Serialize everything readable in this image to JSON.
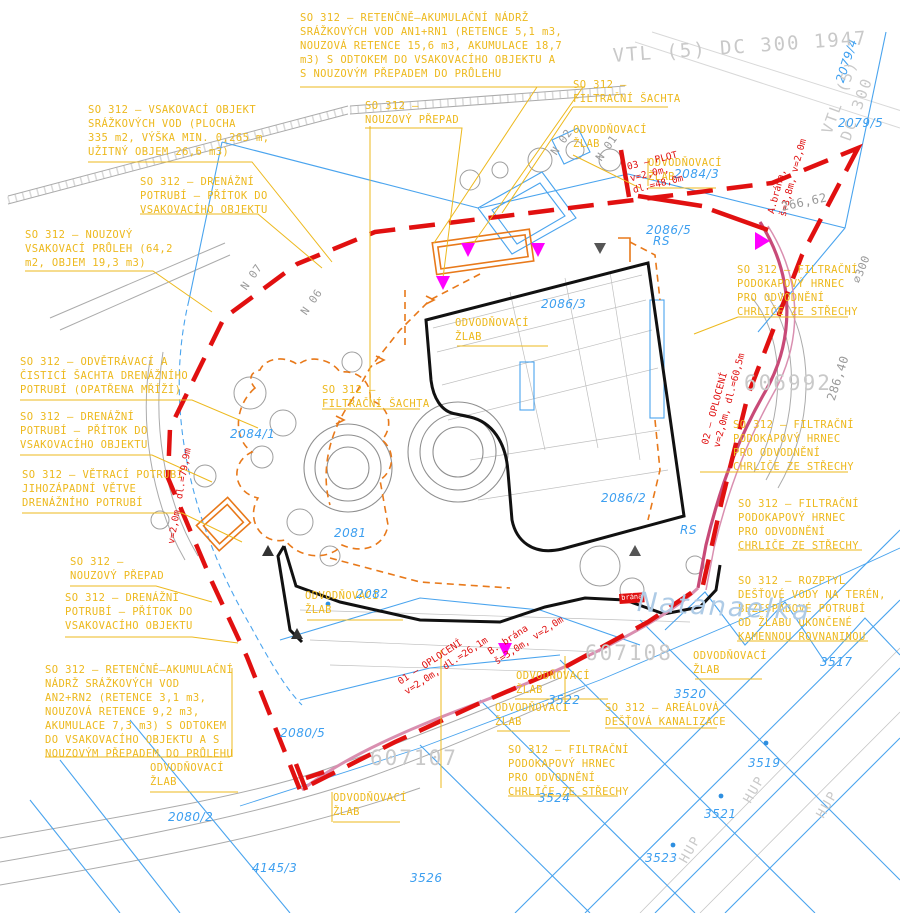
{
  "document_type": "site drainage plan (CAD drawing)",
  "palette": {
    "label_yellow": "#EDB91E",
    "drainage_orange": "#E8791A",
    "boundary_red": "#E01010",
    "road_crimson": "#C84A78",
    "marker_magenta": "#FF00FF",
    "parcel_blue": "#3D9FF0",
    "cadastre_blue": "#4AA4EE",
    "base_gray": "#9A9A9A",
    "pale_gray": "#C9C9C9",
    "building_black": "#111111"
  },
  "annotations": {
    "so312_labels": [
      {
        "id": "an1",
        "x": 300,
        "y": 12,
        "t": "SO 312 – RETENČNĚ–AKUMULAČNÍ NÁDRŽ\nSRÁŽKOVÝCH VOD AN1+RN1 (RETENCE 5,1 m3,\nNOUZOVÁ RETENCE 15,6 m3, AKUMULACE 18,7\nm3) S ODTOKEM DO VSAKOVACÍHO OBJEKTU A\nS NOUZOVÝM PŘEPADEM DO PRŮLEHU"
      },
      {
        "id": "vsak-objekt",
        "x": 88,
        "y": 104,
        "t": "SO 312 – VSAKOVACÍ OBJEKT\nSRÁŽKOVÝCH VOD (PLOCHA\n335 m2, VÝŠKA MIN. 0,265 m,\nUŽITNÝ OBJEM 26,6 m3)"
      },
      {
        "id": "drenazni-1",
        "x": 140,
        "y": 176,
        "t": "SO 312 – DRENÁŽNÍ\nPOTRUBÍ – PŘÍTOK DO\nVSAKOVACÍHO OBJEKTU"
      },
      {
        "id": "nouzovy-pruleh",
        "x": 25,
        "y": 229,
        "t": "SO 312 – NOUZOVÝ\nVSAKOVACÍ PRŮLEH (64,2\nm2, OBJEM 19,3 m3)"
      },
      {
        "id": "nouzovy-prepad-top",
        "x": 365,
        "y": 100,
        "t": "SO 312 –\nNOUZOVÝ PŘEPAD"
      },
      {
        "id": "filtracni-sachta-top",
        "x": 573,
        "y": 79,
        "t": "SO 312 –\nFILTRAČNÍ ŠACHTA"
      },
      {
        "id": "odvetravaci-sachta",
        "x": 20,
        "y": 356,
        "t": "SO 312 – ODVĚTRÁVACÍ A\nČISTICÍ ŠACHTA DRENÁŽNÍHO\nPOTRUBÍ (OPATŘENA MŘÍŽÍ)"
      },
      {
        "id": "drenazni-2",
        "x": 20,
        "y": 411,
        "t": "SO 312 – DRENÁŽNÍ\nPOTRUBÍ – PŘÍTOK DO\nVSAKOVACÍHO OBJEKTU"
      },
      {
        "id": "vetraci-potrubi",
        "x": 22,
        "y": 469,
        "t": "SO 312 – VĚTRACÍ POTRUBÍ\nJIHOZÁPADNÍ VĚTVE\nDRENÁŽNÍHO POTRUBÍ"
      },
      {
        "id": "nouzovy-prepad-left",
        "x": 70,
        "y": 556,
        "t": "SO 312 –\nNOUZOVÝ PŘEPAD"
      },
      {
        "id": "drenazni-3",
        "x": 65,
        "y": 592,
        "t": "SO 312 – DRENÁŽNÍ\nPOTRUBÍ – PŘÍTOK DO\nVSAKOVACÍHO OBJEKTU"
      },
      {
        "id": "an2",
        "x": 45,
        "y": 664,
        "t": "SO 312 – RETENČNĚ–AKUMULAČNÍ\nNÁDRŽ SRÁŽKOVÝCH VOD\nAN2+RN2 (RETENCE 3,1 m3,\nNOUZOVÁ RETENCE 9,2 m3,\nAKUMULACE 7,3 m3) S ODTOKEM\nDO VSAKOVACÍHO OBJEKTU A S\nNOUZOVÝM PŘEPADEM DO PRŮLEHU"
      },
      {
        "id": "filtracni-sachta-mid",
        "x": 322,
        "y": 384,
        "t": "SO 312 –\nFILTRAČNÍ ŠACHTA"
      },
      {
        "id": "hrnec-1",
        "x": 737,
        "y": 264,
        "t": "SO 312 – FILTRAČNÍ\nPODOKAPOVÝ HRNEC\nPRO ODVODNĚNÍ\nCHRLIČE ZE STŘECHY"
      },
      {
        "id": "hrnec-2",
        "x": 733,
        "y": 419,
        "t": "SO 312 – FILTRAČNÍ\nPODOKAPOVÝ HRNEC\nPRO ODVODNĚNÍ\nCHRLIČE ZE STŘECHY"
      },
      {
        "id": "hrnec-3",
        "x": 738,
        "y": 498,
        "t": "SO 312 – FILTRAČNÍ\nPODOKAPOVÝ HRNEC\nPRO ODVODNĚNÍ\nCHRLIČE ZE STŘECHY"
      },
      {
        "id": "rozptyl",
        "x": 738,
        "y": 575,
        "t": "SO 312 – ROZPTYL\nDEŠŤOVÉ VODY NA TERÉN,\nBEZESPÁDOVÉ POTRUBÍ\nOD ŽLABU UKONČENÉ\nKAMENNOU ROVNANINOU"
      },
      {
        "id": "arealova-kanalizace",
        "x": 605,
        "y": 702,
        "t": "SO 312 – AREÁLOVÁ\nDEŠŤOVÁ KANALIZACE"
      },
      {
        "id": "hrnec-4",
        "x": 508,
        "y": 744,
        "t": "SO 312 – FILTRAČNÍ\nPODOKAPOVÝ HRNEC\nPRO ODVODNĚNÍ\nCHRLIČE ZE STŘECHY"
      }
    ],
    "gutter_labels": [
      {
        "id": "zlab-tr1",
        "x": 573,
        "y": 124,
        "t": "ODVODŇOVACÍ\nŽLAB"
      },
      {
        "id": "zlab-tr2",
        "x": 648,
        "y": 157,
        "t": "ODVODŇOVACÍ\nŽLAB"
      },
      {
        "id": "zlab-center",
        "x": 455,
        "y": 317,
        "t": "ODVODŇOVACÍ\nŽLAB"
      },
      {
        "id": "zlab-mid-left",
        "x": 305,
        "y": 590,
        "t": "ODVODŇOVACÍ\nŽLAB"
      },
      {
        "id": "zlab-bottom-left",
        "x": 150,
        "y": 762,
        "t": "ODVODŇOVACÍ\nŽLAB"
      },
      {
        "id": "zlab-bottom-left2",
        "x": 333,
        "y": 792,
        "t": "ODVODŇOVACÍ\nŽLAB"
      },
      {
        "id": "zlab-right",
        "x": 693,
        "y": 650,
        "t": "ODVODŇOVACÍ\nŽLAB"
      },
      {
        "id": "zlab-b1",
        "x": 516,
        "y": 670,
        "t": "ODVODŇOVACÍ\nŽLAB"
      },
      {
        "id": "zlab-b2",
        "x": 495,
        "y": 702,
        "t": "ODVODŇOVACÍ\nŽLAB"
      }
    ],
    "parcel_numbers": [
      {
        "id": "p2081",
        "c": "blue",
        "x": 334,
        "y": 526,
        "t": "2081"
      },
      {
        "id": "p2082",
        "c": "blue",
        "x": 356,
        "y": 587,
        "t": "2082"
      },
      {
        "id": "p2084-1",
        "c": "blue",
        "x": 230,
        "y": 427,
        "t": "2084/1"
      },
      {
        "id": "p2084-3",
        "c": "blue",
        "x": 674,
        "y": 167,
        "t": "2084/3"
      },
      {
        "id": "p2086-3",
        "c": "blue",
        "x": 541,
        "y": 297,
        "t": "2086/3"
      },
      {
        "id": "p2086-2",
        "c": "blue",
        "x": 601,
        "y": 491,
        "t": "2086/2"
      },
      {
        "id": "p2086-5",
        "c": "blue",
        "x": 646,
        "y": 223,
        "t": "2086/5"
      },
      {
        "id": "p2079-4",
        "c": "blue",
        "x": 833,
        "y": 80,
        "r": -72,
        "t": "2079/4"
      },
      {
        "id": "p2079-5",
        "c": "blue",
        "x": 838,
        "y": 116,
        "t": "2079/5"
      },
      {
        "id": "p2080-2",
        "c": "blue",
        "x": 168,
        "y": 810,
        "t": "2080/2"
      },
      {
        "id": "p2080-5",
        "c": "blue",
        "x": 280,
        "y": 726,
        "t": "2080/5"
      },
      {
        "id": "p3517",
        "c": "blue",
        "x": 820,
        "y": 655,
        "t": "3517"
      },
      {
        "id": "p3519",
        "c": "blue",
        "x": 748,
        "y": 756,
        "t": "3519"
      },
      {
        "id": "p3520",
        "c": "blue",
        "x": 674,
        "y": 687,
        "t": "3520"
      },
      {
        "id": "p3521",
        "c": "blue",
        "x": 704,
        "y": 807,
        "t": "3521"
      },
      {
        "id": "p3522",
        "c": "blue",
        "x": 548,
        "y": 693,
        "t": "3522"
      },
      {
        "id": "p3523",
        "c": "blue",
        "x": 645,
        "y": 851,
        "t": "3523"
      },
      {
        "id": "p3524",
        "c": "blue",
        "x": 538,
        "y": 791,
        "t": "3524"
      },
      {
        "id": "p3526",
        "c": "blue",
        "x": 410,
        "y": 871,
        "t": "3526"
      },
      {
        "id": "p4145-3",
        "c": "blue",
        "x": 252,
        "y": 861,
        "t": "4145/3"
      },
      {
        "id": "rs-1",
        "c": "blue",
        "x": 653,
        "y": 234,
        "t": "RS"
      },
      {
        "id": "rs-2",
        "c": "blue",
        "x": 680,
        "y": 523,
        "t": "RS"
      }
    ],
    "red_notes": [
      {
        "id": "plot-03",
        "c": "red",
        "x": 626,
        "y": 162,
        "r": -14,
        "t": "03 – PLOT\nv=2,0m,\ndl.=48,0m"
      },
      {
        "id": "brana-a",
        "c": "red",
        "x": 766,
        "y": 212,
        "r": -75,
        "t": "A.brána,\nš=3,8m, v=2,0m"
      },
      {
        "id": "oploceni-02",
        "c": "red",
        "x": 700,
        "y": 443,
        "r": -75,
        "t": "02 – OPLOCENÍ\nv=2,0m, dl.=60,5m"
      },
      {
        "id": "oploceni-01",
        "c": "red",
        "x": 396,
        "y": 678,
        "r": -33,
        "t": "01 – OPLOCENÍ\nv=2,0m, dl.=26,1m"
      },
      {
        "id": "brana-b",
        "c": "red",
        "x": 486,
        "y": 648,
        "r": -33,
        "t": "B. brána\nš=3,0m, v=2,0m"
      },
      {
        "id": "dren-79",
        "c": "red",
        "x": 166,
        "y": 543,
        "r": -80,
        "t": "v=2,0m, dl.=79,9m"
      },
      {
        "id": "brana-tag",
        "c": "redbox",
        "x": 619,
        "y": 594,
        "r": -4,
        "t": "brána"
      }
    ],
    "gray_texts": [
      {
        "id": "vtl-line",
        "c": "paleg",
        "x": 612,
        "y": 44,
        "r": -4,
        "s": 19,
        "t": "VTL (5) DC 300 1947"
      },
      {
        "id": "vtl-line-2",
        "c": "paleg",
        "x": 818,
        "y": 130,
        "r": -70,
        "s": 15,
        "t": "VTL (5) DC 300"
      },
      {
        "id": "pt-606992",
        "c": "paleg",
        "x": 744,
        "y": 370,
        "s": 21,
        "t": "606992"
      },
      {
        "id": "pt-607107",
        "c": "paleg",
        "x": 370,
        "y": 745,
        "s": 21,
        "t": "607107"
      },
      {
        "id": "pt-607108",
        "c": "paleg",
        "x": 585,
        "y": 640,
        "s": 21,
        "t": "607108"
      },
      {
        "id": "elev-266",
        "c": "gray",
        "x": 780,
        "y": 200,
        "r": -12,
        "s": 12,
        "t": "266,62"
      },
      {
        "id": "elev-286",
        "c": "gray",
        "x": 824,
        "y": 398,
        "r": -72,
        "s": 12,
        "t": "286,40"
      },
      {
        "id": "pipe-300",
        "c": "gray",
        "x": 850,
        "y": 280,
        "r": -68,
        "s": 11,
        "t": "⌀300"
      },
      {
        "id": "n07",
        "c": "gray",
        "x": 238,
        "y": 285,
        "r": -55,
        "s": 11,
        "t": "N 07"
      },
      {
        "id": "n06",
        "c": "gray",
        "x": 298,
        "y": 310,
        "r": -55,
        "s": 11,
        "t": "N 06"
      },
      {
        "id": "n02",
        "c": "gray",
        "x": 548,
        "y": 150,
        "r": -55,
        "s": 11,
        "t": "N 02"
      },
      {
        "id": "n01",
        "c": "gray",
        "x": 593,
        "y": 156,
        "r": -55,
        "s": 11,
        "t": "N 01"
      },
      {
        "id": "hup-1",
        "c": "paleg",
        "x": 740,
        "y": 798,
        "r": -60,
        "s": 13,
        "t": "HUP"
      },
      {
        "id": "hup-2",
        "c": "paleg",
        "x": 676,
        "y": 858,
        "r": -60,
        "s": 13,
        "t": "HUP"
      },
      {
        "id": "hup-3",
        "c": "paleg",
        "x": 813,
        "y": 813,
        "r": -60,
        "s": 13,
        "t": "HUP"
      }
    ],
    "watermarks": [
      {
        "id": "street-name",
        "c": "blueb",
        "x": 638,
        "y": 585,
        "r": 3,
        "t": "Natanaelka"
      }
    ]
  }
}
